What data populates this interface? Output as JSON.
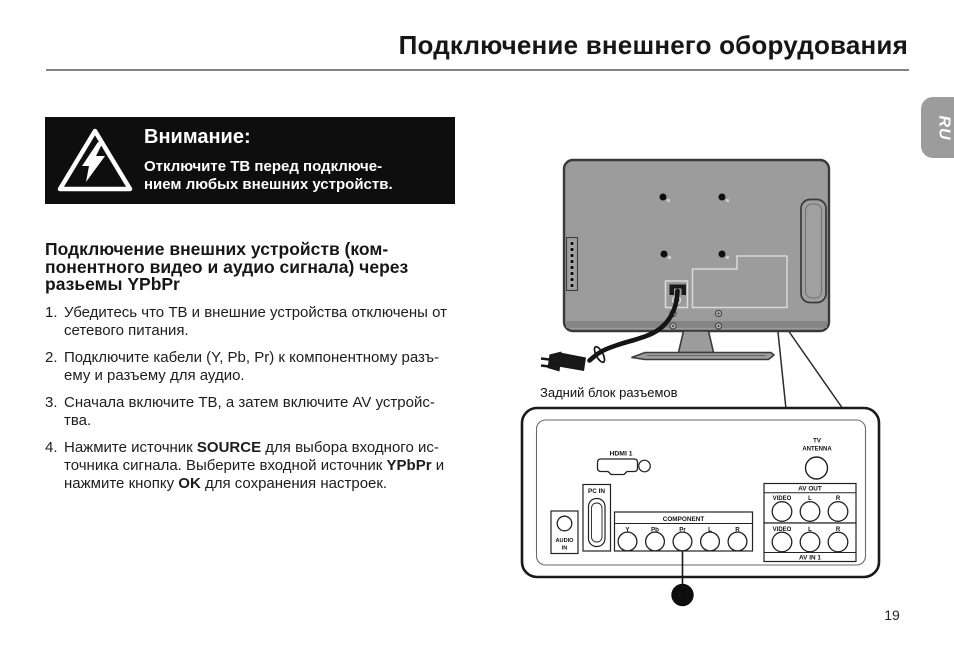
{
  "page": {
    "title": "Подключение внешнего оборудования",
    "page_number": "19",
    "language_tab": "RU"
  },
  "warning": {
    "heading": "Внимание:",
    "line1": "Отключите ТВ перед подключе-",
    "line2": "нием любых внешних устройств."
  },
  "section": {
    "heading_line1": "Подключение внешних устройств (ком-",
    "heading_line2": "понентного видео и аудио сигнала) через",
    "heading_line3": "разьемы YPbPr",
    "steps": [
      {
        "num": "1.",
        "lines": [
          [
            {
              "t": "Убедитесь что ТВ и внешние устройства отключены от"
            }
          ],
          [
            {
              "t": "сетевого питания."
            }
          ]
        ]
      },
      {
        "num": "2.",
        "lines": [
          [
            {
              "t": "Подключите кабели (Y, Pb, Pr) к компонентному разъ-"
            }
          ],
          [
            {
              "t": "ему и разъему для аудио."
            }
          ]
        ]
      },
      {
        "num": "3.",
        "lines": [
          [
            {
              "t": "Сначала включите ТВ, а затем включите AV устройс-"
            }
          ],
          [
            {
              "t": "тва."
            }
          ]
        ]
      },
      {
        "num": "4.",
        "lines": [
          [
            {
              "t": "Нажмите источник "
            },
            {
              "t": "SOURCE",
              "b": true
            },
            {
              "t": " для выбора входного ис-"
            }
          ],
          [
            {
              "t": "точника сигнала. Выберите входной источник "
            },
            {
              "t": "YPbPr",
              "b": true
            },
            {
              "t": " и"
            }
          ],
          [
            {
              "t": "нажмите кнопку "
            },
            {
              "t": "OK",
              "b": true
            },
            {
              "t": " для сохранения настроек."
            }
          ]
        ]
      }
    ]
  },
  "diagram": {
    "caption": "Задний блок разъемов",
    "badge": "14",
    "panel": {
      "hdmi_label": "HDMI 1",
      "pc_in_label": "PC IN",
      "audio_in_label_1": "AUDIO",
      "audio_in_label_2": "IN",
      "component_title": "COMPONENT",
      "component_jacks": [
        "Y",
        "Pb",
        "Pr",
        "L",
        "R"
      ],
      "antenna_label_1": "TV",
      "antenna_label_2": "ANTENNA",
      "av_out_title": "AV OUT",
      "av_out_jacks": [
        "VIDEO",
        "L",
        "R"
      ],
      "av_in_title": "AV IN 1",
      "av_in_jacks": [
        "VIDEO",
        "L",
        "R"
      ]
    }
  }
}
